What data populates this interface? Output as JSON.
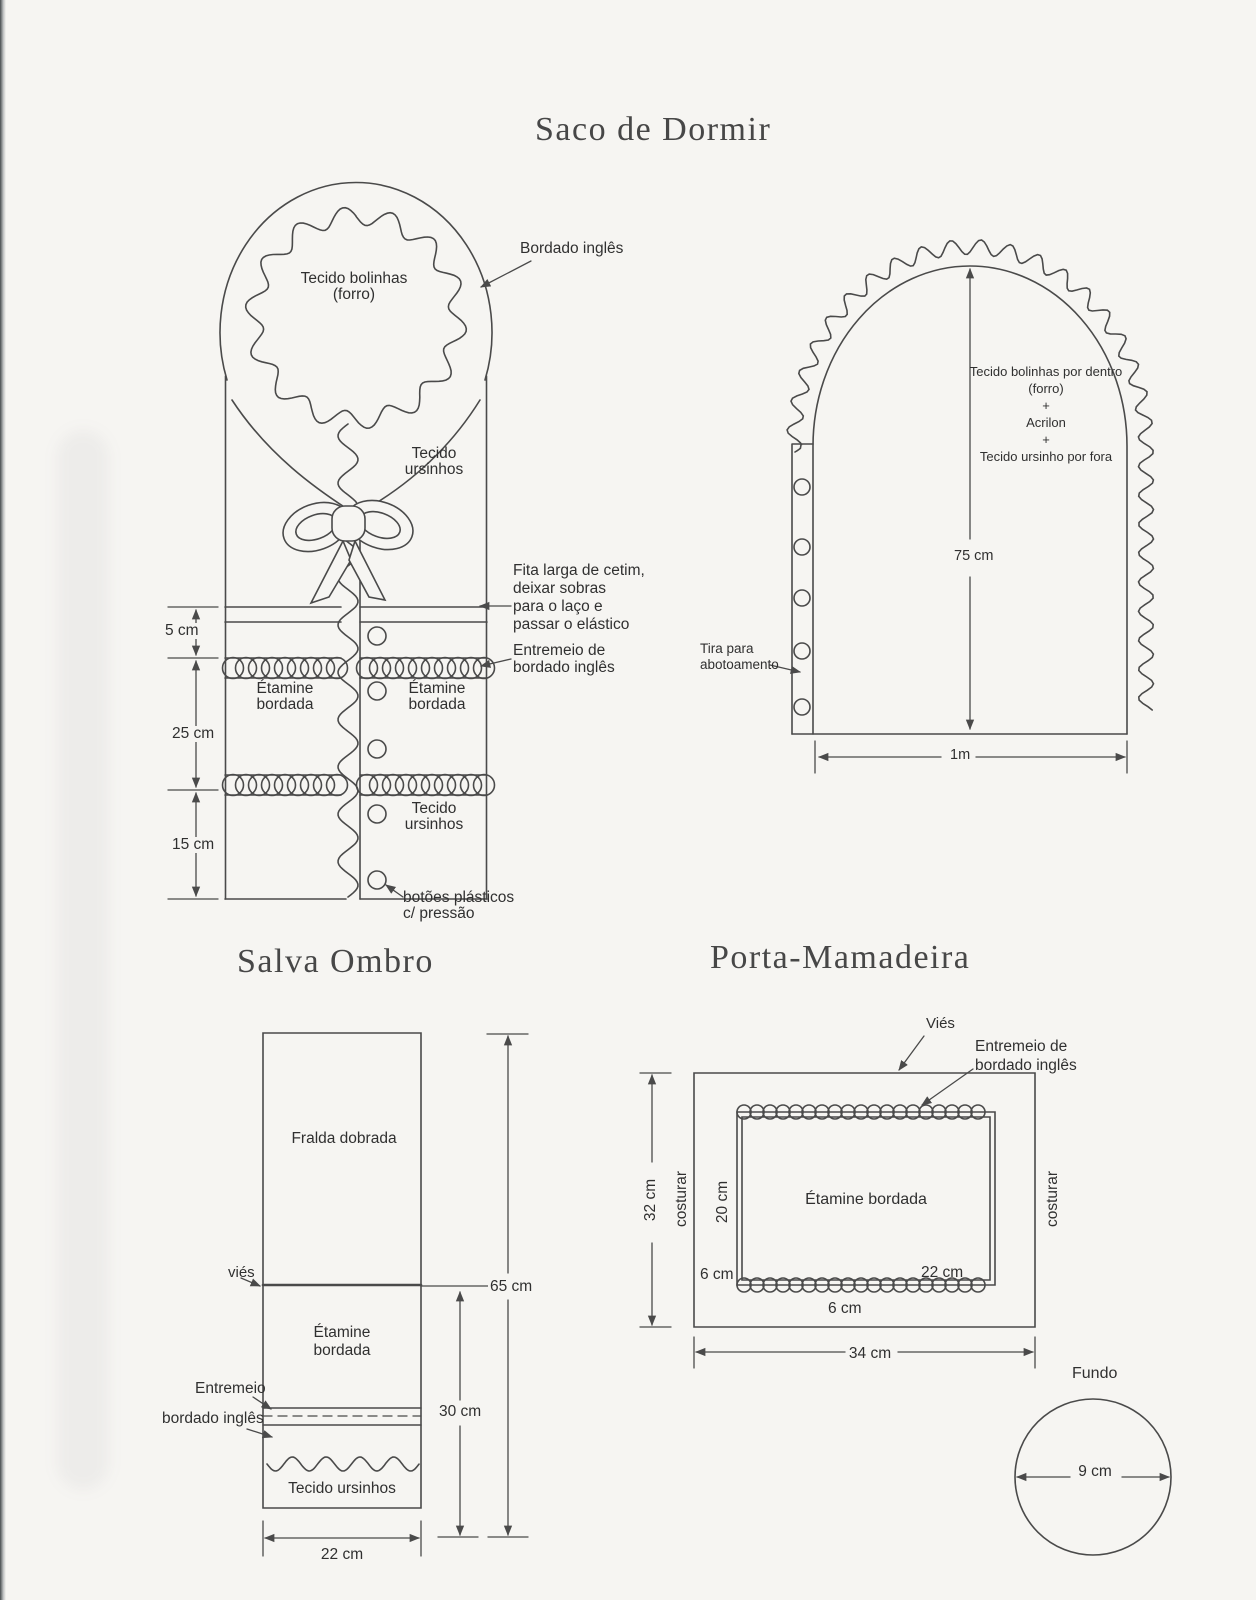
{
  "page": {
    "background": "#f6f5f2",
    "ink": "#4a4a4a"
  },
  "saco_de_dormir": {
    "title": "Saco de Dormir",
    "hood": {
      "lining_line1": "Tecido bolinhas",
      "lining_line2": "(forro)",
      "trim_label": "Bordado inglês",
      "outer_line1": "Tecido",
      "outer_line2": "ursinhos"
    },
    "ribbon_note": [
      "Fita larga de cetim,",
      "deixar sobras",
      "para o laço e",
      "passar o elástico"
    ],
    "eyelet_note": [
      "Entremeio de",
      "bordado inglês"
    ],
    "left_column": {
      "line1": "Étamine",
      "line2": "bordada"
    },
    "right_column": {
      "line1": "Étamine",
      "line2": "bordada",
      "fabric_line1": "Tecido",
      "fabric_line2": "ursinhos"
    },
    "buttons_note": [
      "botões plásticos",
      "c/ pressão"
    ],
    "dims": {
      "top": "5 cm",
      "middle": "25 cm",
      "bottom": "15 cm"
    }
  },
  "hood_panel": {
    "layers": [
      "Tecido bolinhas por dentro",
      "(forro)",
      "+",
      "Acrilon",
      "+",
      "Tecido ursinho por fora"
    ],
    "strip_note": [
      "Tira para",
      "abotoamento"
    ],
    "dims": {
      "height": "75 cm",
      "width": "1m"
    }
  },
  "salva_ombro": {
    "title": "Salva Ombro",
    "labels": {
      "top_panel": "Fralda dobrada",
      "bias": "viés",
      "etamine_line1": "Étamine",
      "etamine_line2": "bordada",
      "entremeio": "Entremeio",
      "bordado": "bordado inglês",
      "bottom_panel": "Tecido ursinhos"
    },
    "dims": {
      "total_height": "65 cm",
      "lower_height": "30 cm",
      "width": "22 cm"
    }
  },
  "porta_mamadeira": {
    "title": "Porta-Mamadeira",
    "labels": {
      "bias": "Viés",
      "eyelet_line1": "Entremeio de",
      "eyelet_line2": "bordado inglês",
      "sew_left": "costurar",
      "sew_right": "costurar",
      "center": "Étamine bordada",
      "bottom_piece": "Fundo"
    },
    "dims": {
      "height": "32 cm",
      "inner_height": "20 cm",
      "seam_left": "6 cm",
      "inner_width": "22 cm",
      "seam_bottom": "6 cm",
      "width": "34 cm",
      "bottom_diameter": "9 cm"
    }
  }
}
